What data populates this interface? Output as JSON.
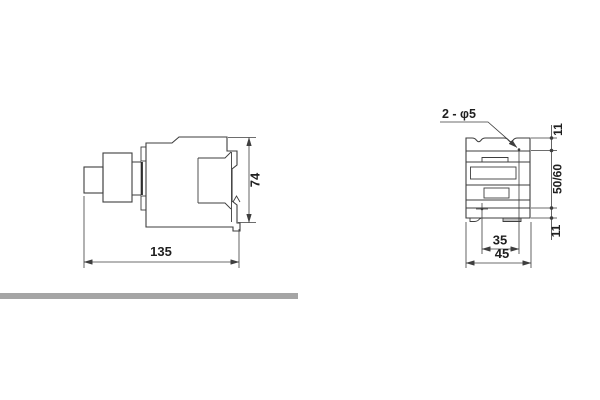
{
  "side_view": {
    "overall_width": "135",
    "overall_height": "74"
  },
  "front_view": {
    "hole_callout": "2 - φ5",
    "hole_top_offset": "11",
    "hole_pitch_vertical": "50/60",
    "hole_bottom_offset": "11",
    "hole_pitch_horizontal": "35",
    "overall_width": "45"
  },
  "colors": {
    "line": "#3e3e3e",
    "text": "#1f1f1f",
    "divider_bar": "#a5a5a5",
    "background": "#ffffff"
  }
}
